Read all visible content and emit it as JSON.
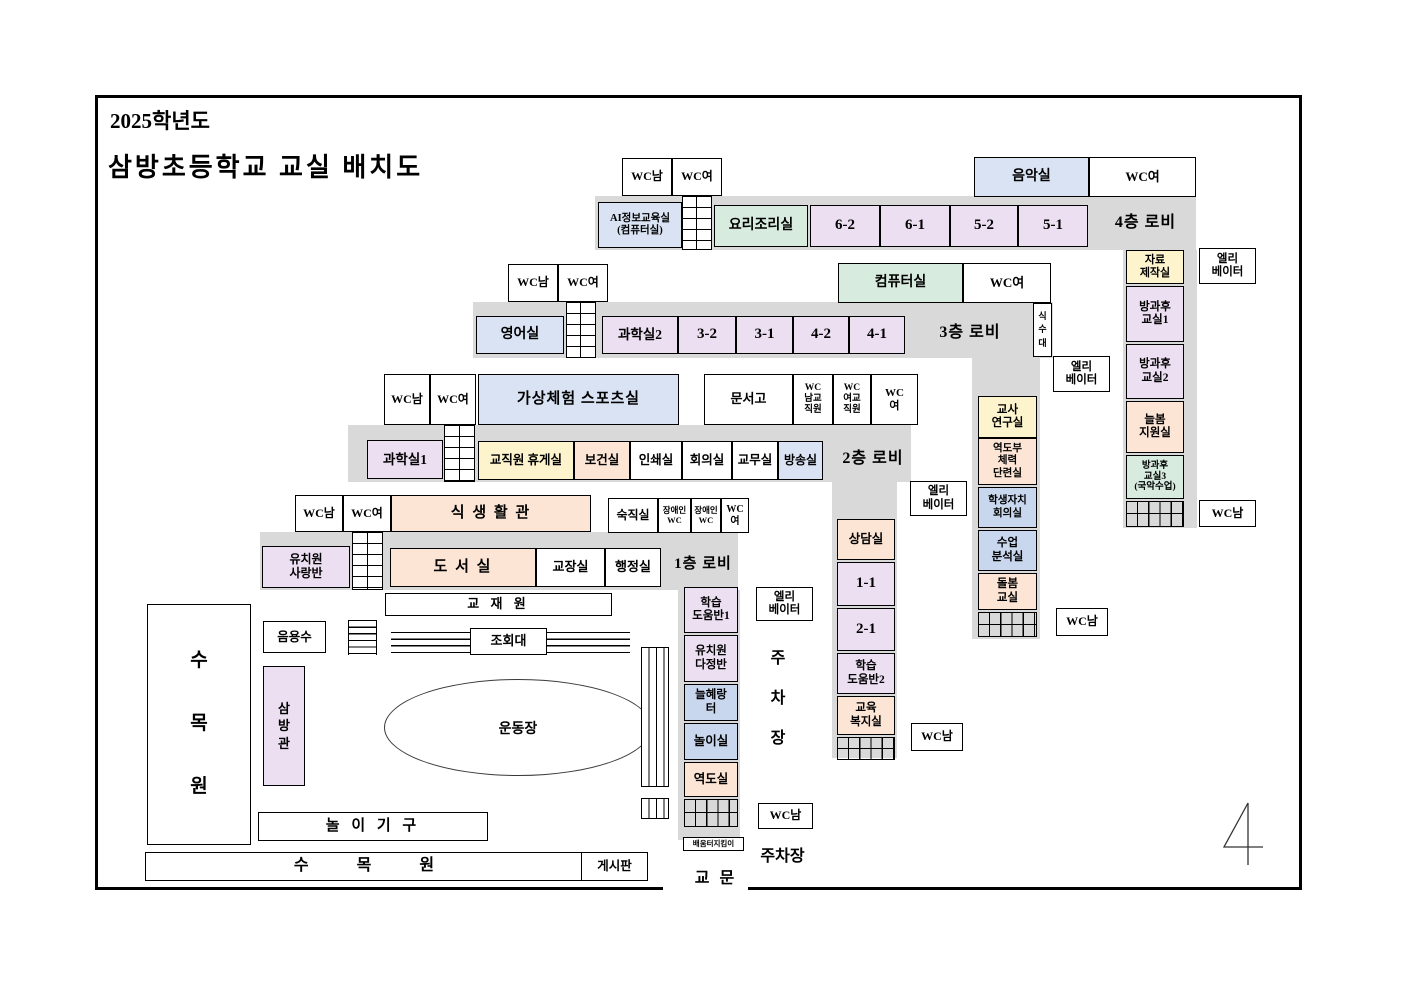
{
  "doc": {
    "year": "2025학년도",
    "title": "삼방초등학교 교실 배치도",
    "page_number": "4"
  },
  "colors": {
    "corridor": "#d9d9d9",
    "blue_room": "#dae3f3",
    "green_room": "#d7ecdf",
    "lavender_room": "#ecdff2",
    "yellow_room": "#fdf3cd",
    "peach_room": "#fce5d5",
    "periwinkle_room": "#c8d6ee"
  },
  "f4": {
    "wc_top_m": "WC남",
    "wc_top_f": "WC여",
    "music": "음악실",
    "wc_right_f": "WC여",
    "ai": "AI정보교육실\n(컴퓨터실)",
    "cooking": "요리조리실",
    "r62": "6-2",
    "r61": "6-1",
    "r52": "5-2",
    "r51": "5-1",
    "lobby": "4층 로비",
    "material": "자료\n제작실",
    "after1": "방과후\n교실1",
    "after2": "방과후\n교실2",
    "neulbom": "늘봄\n지원실",
    "after3": "방과후\n교실3\n(국악수업)",
    "elevator": "엘리\n베이터",
    "wc_wing": "WC남"
  },
  "f3": {
    "wc_top_m": "WC남",
    "wc_top_f": "WC여",
    "computer": "컴퓨터실",
    "wc_right_f": "WC여",
    "english": "영어실",
    "science2": "과학실2",
    "r32": "3-2",
    "r31": "3-1",
    "r42": "4-2",
    "r41": "4-1",
    "lobby": "3층 로비",
    "fountain": "식\n수\n대",
    "teacher_lab": "교사\n연구실",
    "weightlifting_gym": "역도부\n체력\n단련실",
    "student_council": "학생자치\n회의실",
    "lesson_analysis": "수업\n분석실",
    "dolbom": "돌봄\n교실",
    "elevator": "엘리\n베이터",
    "wc_wing": "WC남"
  },
  "f2": {
    "wc_top_m": "WC남",
    "wc_top_f": "WC여",
    "vr_sports": "가상체험 스포츠실",
    "archive": "문서고",
    "wc_staff_m": "WC\n남교\n직원",
    "wc_staff_f": "WC\n여교\n직원",
    "wc_f": "WC\n여",
    "science1": "과학실1",
    "lounge": "교직원 휴게실",
    "health": "보건실",
    "print": "인쇄실",
    "meeting": "회의실",
    "office": "교무실",
    "broadcast": "방송실",
    "lobby": "2층 로비",
    "counseling": "상담실",
    "r11": "1-1",
    "r21": "2-1",
    "help2": "학습\n도움반2",
    "welfare": "교육\n복지실",
    "elevator": "엘리\n베이터",
    "wc_wing": "WC남"
  },
  "f1": {
    "wc_top_m": "WC남",
    "wc_top_f": "WC여",
    "dining": "식 생 활 관",
    "night_duty": "숙직실",
    "wc_disabled1": "장애인\nWC",
    "wc_disabled2": "장애인\nWC",
    "wc_f": "WC\n여",
    "kinder_sarang": "유치원\n사랑반",
    "library": "도 서 실",
    "principal": "교장실",
    "admin": "행정실",
    "lobby": "1층 로비",
    "help1": "학습\n도움반1",
    "kinder_dajeong": "유치원\n다정반",
    "neulhaerang": "늘혜랑\n터",
    "playroom": "놀이실",
    "weightroom": "역도실",
    "elevator": "엘리\n베이터",
    "parking_side": "주\n차\n장",
    "wc_wing": "WC남",
    "guard": "배움터지킴이",
    "parking": "주차장",
    "gate": "교 문"
  },
  "grounds": {
    "arboretum_left": "수\n목\n원",
    "drinking_water": "음용수",
    "sambang_hall": "삼\n방\n관",
    "teaching_garden": "교 재 원",
    "assembly_stand": "조회대",
    "playfield": "운동장",
    "play_equipment": "놀 이 기 구",
    "arboretum_bottom": "수            목            원",
    "bulletin_board": "게시판"
  }
}
